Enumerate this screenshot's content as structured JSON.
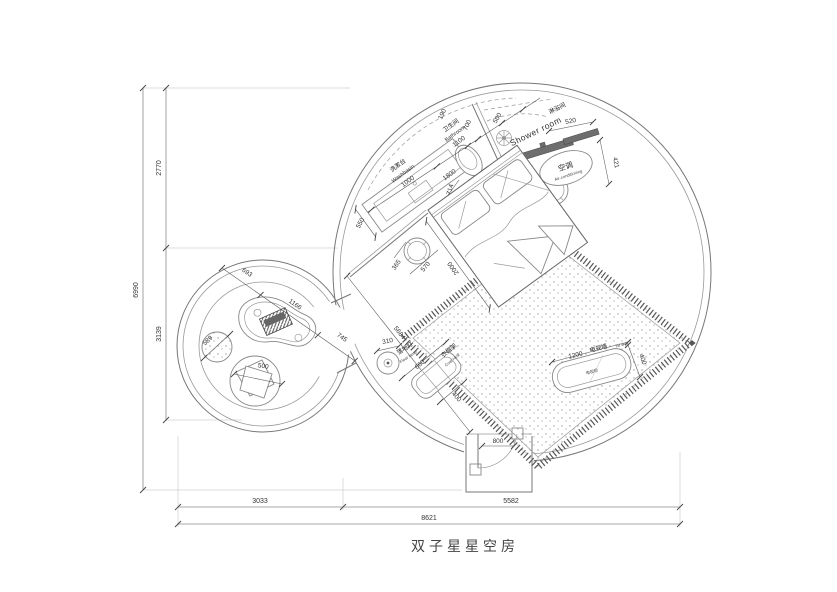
{
  "title": "双子星星空房",
  "labels": {
    "washbasin_zh": "洗漱台",
    "washbasin_en": "Washbasin",
    "bathroom_zh": "卫生间",
    "bathroom_en": "Bathroom",
    "shower_zh": "淋浴间",
    "shower_en": "Shower room",
    "ac_zh": "空调",
    "ac_en": "Air-conditioning",
    "lamp_zh": "落地灯",
    "lamp_en": "Floor lamp",
    "rack_zh": "衣帽架",
    "rack_en": "Coat rack",
    "tv_zh": "电视墙",
    "tv_en": "TV wall",
    "tv_cabinet": "电视柜"
  },
  "dims": {
    "left_total": "6990",
    "left_top": "2770",
    "left_bottom": "3139",
    "bottom_left": "3033",
    "bottom_right": "5582",
    "bottom_total": "8621",
    "washbasin": "1000",
    "bathroom": "1100",
    "counter_depth": "550",
    "c190": "190",
    "c700": "700",
    "c500": "500",
    "ac_len": "520",
    "ac_depth": "421",
    "toilet_gap": "714",
    "bed_width": "1800",
    "shower_gap": "590",
    "bed_length": "2000",
    "wall_diag": "5684",
    "table_a": "365",
    "table_b": "570",
    "lamp": "310",
    "rack_len": "660",
    "rack_depth": "400",
    "tv_len": "1200",
    "tv_depth": "400",
    "door": "800",
    "sc_a": "693",
    "sc_b": "1166",
    "sc_c": "745",
    "stool": "589",
    "chair": "500"
  }
}
